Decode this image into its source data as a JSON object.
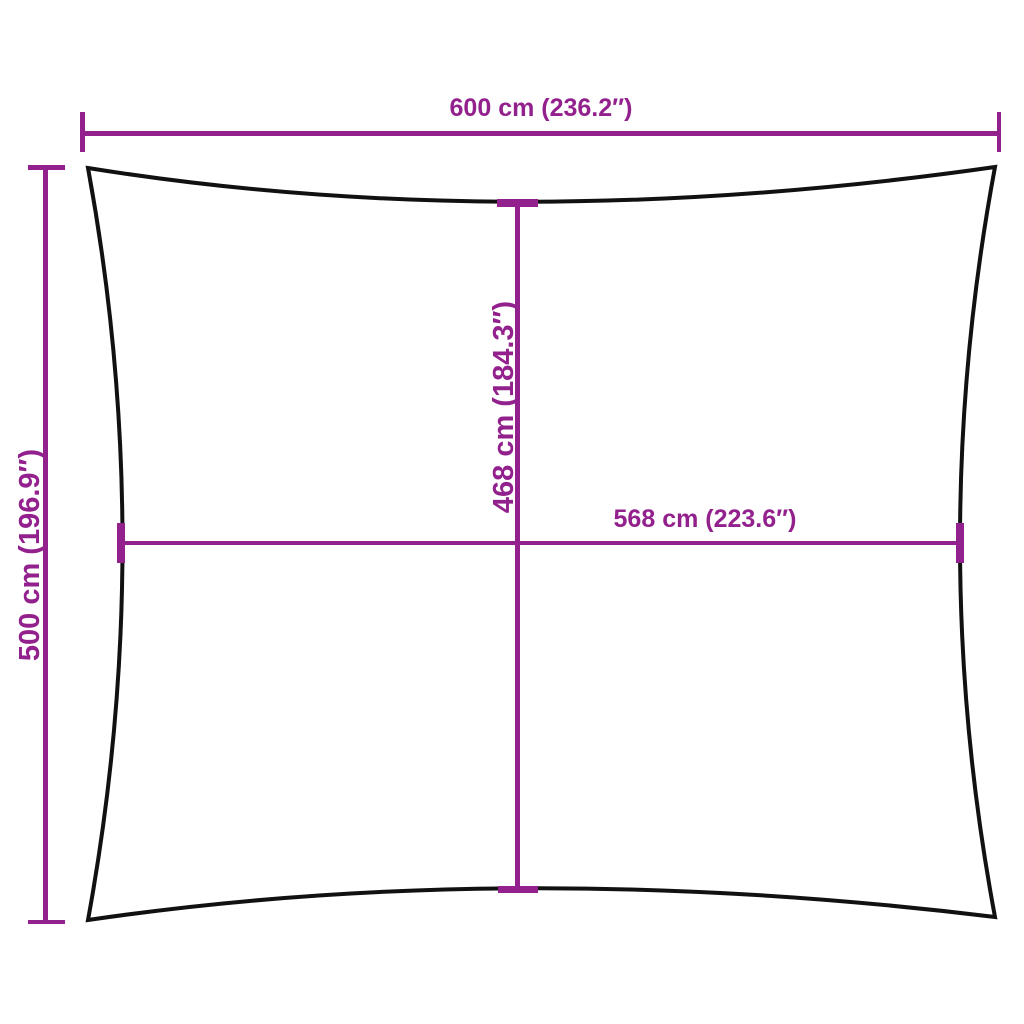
{
  "diagram": {
    "background": "#ffffff",
    "colors": {
      "dimension": "#93218D",
      "outline": "#111111"
    },
    "labels": {
      "top_width": "600 cm (236.2″)",
      "side_height": "500 cm (196.9″)",
      "inner_height": "468 cm (184.3″)",
      "inner_width": "568 cm (223.6″)"
    }
  }
}
